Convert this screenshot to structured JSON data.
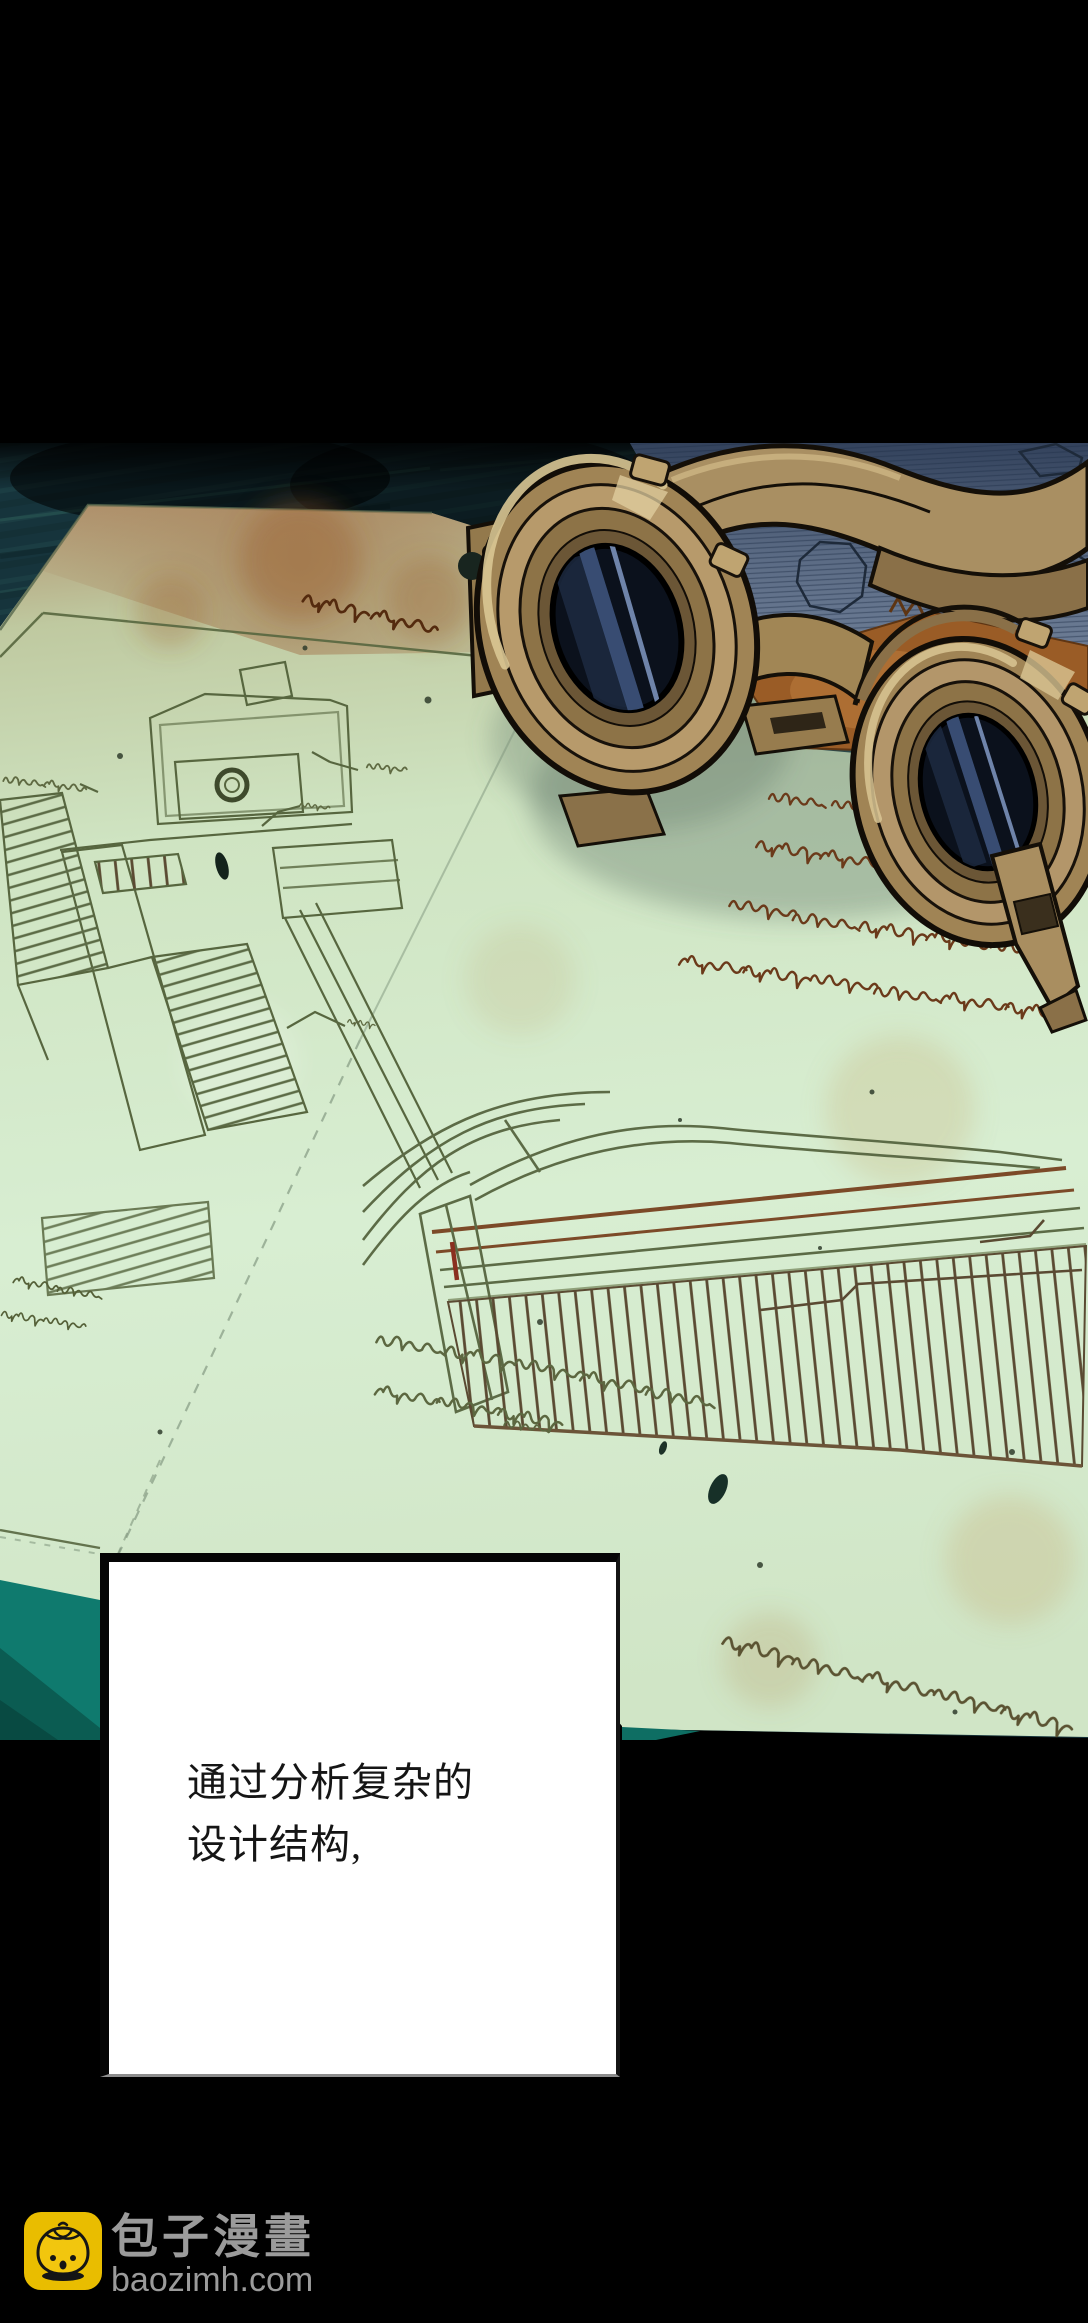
{
  "page": {
    "type": "comic-panel",
    "background": "#000000"
  },
  "dialogue": {
    "box_background": "#ffffff",
    "border_color": "#000000",
    "text_color": "#151515",
    "line1": "通过分析复杂的",
    "line2": "设计结构,"
  },
  "watermark": {
    "icon": "baozi-bun-icon",
    "icon_background": "#e9bd00",
    "site_name": "包子漫畫",
    "site_url": "baozimh.com",
    "text_color": "#9b9b9b"
  },
  "artwork": {
    "scene": "brass goggles resting on aged blueprint papers on a teal wooden table",
    "colors": {
      "table_teal": "#16343c",
      "table_teal_bright": "#0f7a6e",
      "table_teal_shade": "#0b5c52",
      "paper_green": "#cfe3c4",
      "paper_tan": "#b2906a",
      "slate_sheet": "#5b6b84",
      "rust": "#9a5c26",
      "brass_light": "#cbb287",
      "brass_mid": "#a98f62",
      "brass_dark": "#6f5a3a",
      "lens_dark": "#0b111c",
      "ink_blueprint": "#57663f",
      "ink_script_brown": "#6b3a1a",
      "ink_script_olive": "#5c6740"
    }
  }
}
